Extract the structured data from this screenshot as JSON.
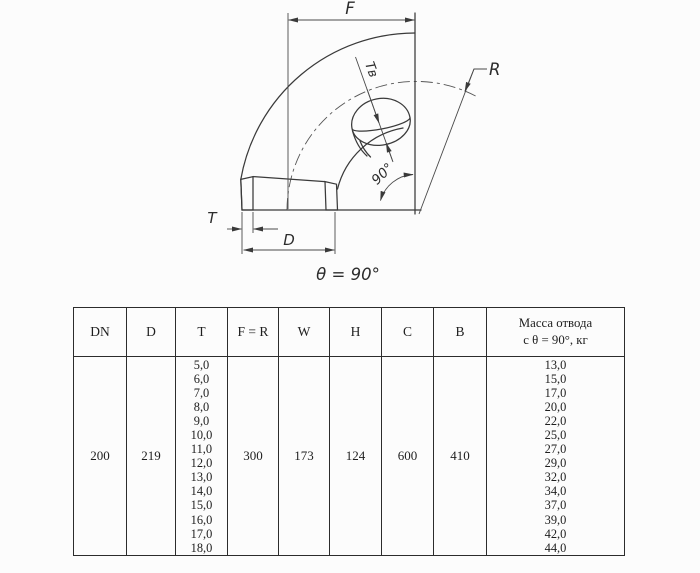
{
  "diagram": {
    "labels": {
      "f": "F",
      "r": "R",
      "t": "T",
      "d": "D",
      "tv": "Tв",
      "angle": "90°",
      "theta": "θ = 90°"
    }
  },
  "table": {
    "headers": {
      "dn": "DN",
      "d": "D",
      "t": "T",
      "fr": "F = R",
      "w": "W",
      "h": "H",
      "c": "C",
      "b": "B",
      "mass_line1": "Масса отвода",
      "mass_line2": "с θ =  90°, кг"
    },
    "row": {
      "dn": "200",
      "d": "219",
      "t_values": [
        "5,0",
        "6,0",
        "7,0",
        "8,0",
        "9,0",
        "10,0",
        "11,0",
        "12,0",
        "13,0",
        "14,0",
        "15,0",
        "16,0",
        "17,0",
        "18,0"
      ],
      "fr": "300",
      "w": "173",
      "h": "124",
      "c": "600",
      "b": "410",
      "mass_values": [
        "13,0",
        "15,0",
        "17,0",
        "20,0",
        "22,0",
        "25,0",
        "27,0",
        "29,0",
        "32,0",
        "34,0",
        "37,0",
        "39,0",
        "42,0",
        "44,0"
      ]
    }
  }
}
